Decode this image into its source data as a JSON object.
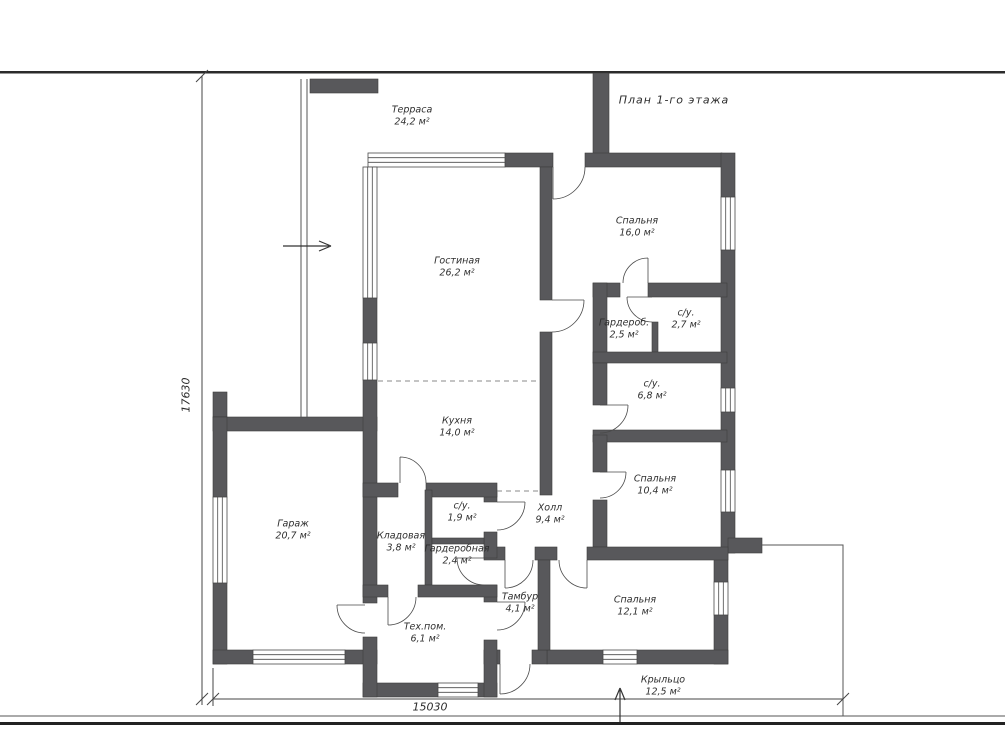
{
  "title": "План 1-го этажа",
  "dimensions": {
    "vertical": "17630",
    "horizontal": "15030"
  },
  "rooms": [
    {
      "id": "terrace",
      "name": "Терраса",
      "area": "24,2 м²",
      "x": 412,
      "y": 117
    },
    {
      "id": "living-room",
      "name": "Гостиная",
      "area": "26,2 м²",
      "x": 457,
      "y": 268
    },
    {
      "id": "bedroom-1",
      "name": "Спальня",
      "area": "16,0 м²",
      "x": 637,
      "y": 228
    },
    {
      "id": "wardrobe",
      "name": "Гардероб.",
      "area": "2,5 м²",
      "x": 624,
      "y": 330
    },
    {
      "id": "bathroom-1",
      "name": "с/у.",
      "area": "2,7 м²",
      "x": 686,
      "y": 320
    },
    {
      "id": "bathroom-2",
      "name": "с/у.",
      "area": "6,8 м²",
      "x": 652,
      "y": 391
    },
    {
      "id": "kitchen",
      "name": "Кухня",
      "area": "14,0 м²",
      "x": 457,
      "y": 428
    },
    {
      "id": "bedroom-2",
      "name": "Спальня",
      "area": "10,4 м²",
      "x": 655,
      "y": 486
    },
    {
      "id": "garage",
      "name": "Гараж",
      "area": "20,7 м²",
      "x": 293,
      "y": 531
    },
    {
      "id": "bathroom-3",
      "name": "с/у.",
      "area": "1,9 м²",
      "x": 462,
      "y": 513
    },
    {
      "id": "hall",
      "name": "Холл",
      "area": "9,4 м²",
      "x": 550,
      "y": 515
    },
    {
      "id": "storage",
      "name": "Кладовая",
      "area": "3,8 м²",
      "x": 401,
      "y": 543
    },
    {
      "id": "dressing-room",
      "name": "Гардеробная",
      "area": "2,4 м²",
      "x": 457,
      "y": 556
    },
    {
      "id": "vestibule",
      "name": "Тамбур",
      "area": "4,1 м²",
      "x": 520,
      "y": 604
    },
    {
      "id": "bedroom-3",
      "name": "Спальня",
      "area": "12,1 м²",
      "x": 635,
      "y": 607
    },
    {
      "id": "utility-room",
      "name": "Тех.пом.",
      "area": "6,1 м²",
      "x": 425,
      "y": 634
    },
    {
      "id": "porch",
      "name": "Крыльцо",
      "area": "12,5 м²",
      "x": 663,
      "y": 687
    }
  ],
  "colors": {
    "wall": "#58585b",
    "line": "#4a4a4a",
    "text": "#2f2f2f",
    "background": "#ffffff"
  }
}
